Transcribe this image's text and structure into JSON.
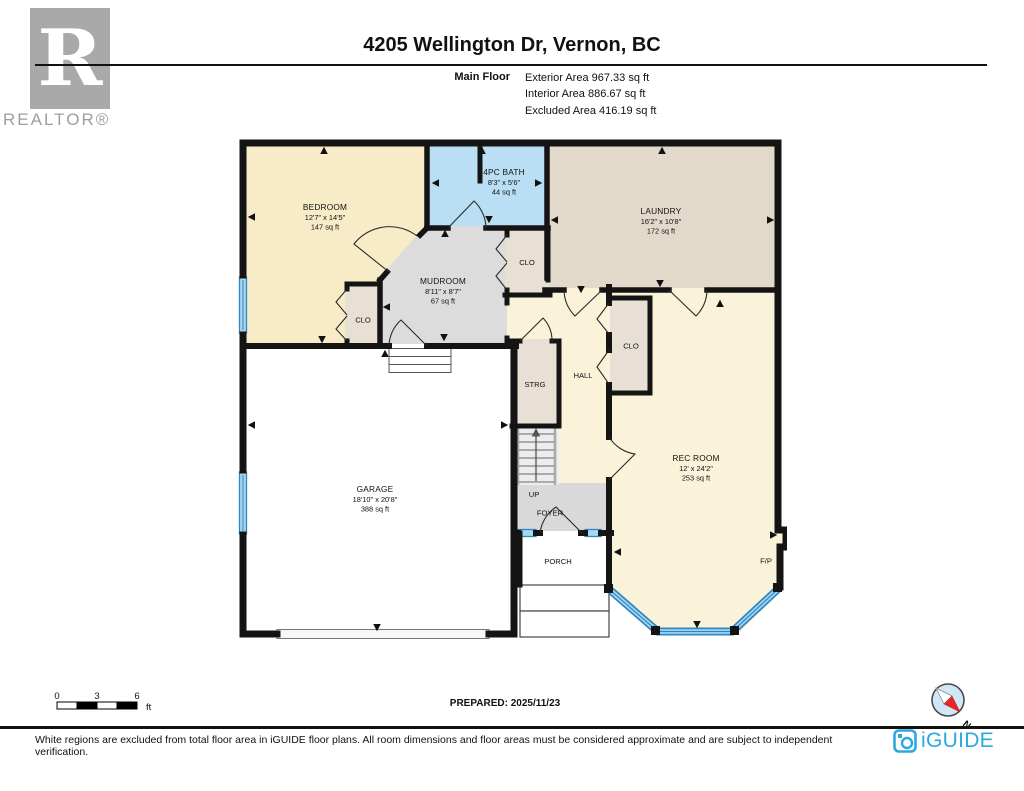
{
  "header": {
    "title": "4205 Wellington Dr, Vernon, BC",
    "floor_label": "Main Floor",
    "exterior_area": "Exterior Area 967.33 sq ft",
    "interior_area": "Interior Area 886.67 sq ft",
    "excluded_area": "Excluded Area 416.19 sq ft"
  },
  "realtor_logo": {
    "letter": "R",
    "text": "REALTOR®"
  },
  "rooms": {
    "bedroom": {
      "name": "BEDROOM",
      "dims": "12'7\" x 14'5\"",
      "area": "147 sq ft"
    },
    "bath": {
      "name": "4PC BATH",
      "dims": "8'3\" x 5'6\"",
      "area": "44 sq ft"
    },
    "laundry": {
      "name": "LAUNDRY",
      "dims": "16'2\" x 10'8\"",
      "area": "172 sq ft"
    },
    "mudroom": {
      "name": "MUDROOM",
      "dims": "8'11\" x 8'7\"",
      "area": "67 sq ft"
    },
    "rec_room": {
      "name": "REC ROOM",
      "dims": "12' x 24'2\"",
      "area": "253 sq ft"
    },
    "garage": {
      "name": "GARAGE",
      "dims": "18'10\" x 20'8\"",
      "area": "388 sq ft"
    }
  },
  "labels": {
    "closet": "CLO",
    "storage": "STRG",
    "hall": "HALL",
    "up": "UP",
    "foyer": "FOYER",
    "porch": "PORCH",
    "fireplace": "F/P"
  },
  "scale_bar": {
    "start": "0",
    "mid": "3",
    "end": "6",
    "unit": "ft"
  },
  "prepared": "PREPARED: 2025/11/23",
  "compass": {
    "north": "N"
  },
  "footer": {
    "disclaimer": "White regions are excluded from total floor area in iGUIDE floor plans. All room dimensions and floor areas must be considered approximate and are subject to independent verification.",
    "brand": "iGUIDE"
  },
  "colors": {
    "wall": "#141414",
    "bedroom": "#f8ecc8",
    "bath": "#badef4",
    "laundry": "#e2d9cb",
    "mudroom": "#dcdcdc",
    "closet": "#e8e0d4",
    "hall": "#faf3da",
    "foyer": "#d9d9d9",
    "window_dark": "#2e86c4",
    "window_light": "#a9d7ef",
    "brand_blue": "#2aa9e1"
  }
}
